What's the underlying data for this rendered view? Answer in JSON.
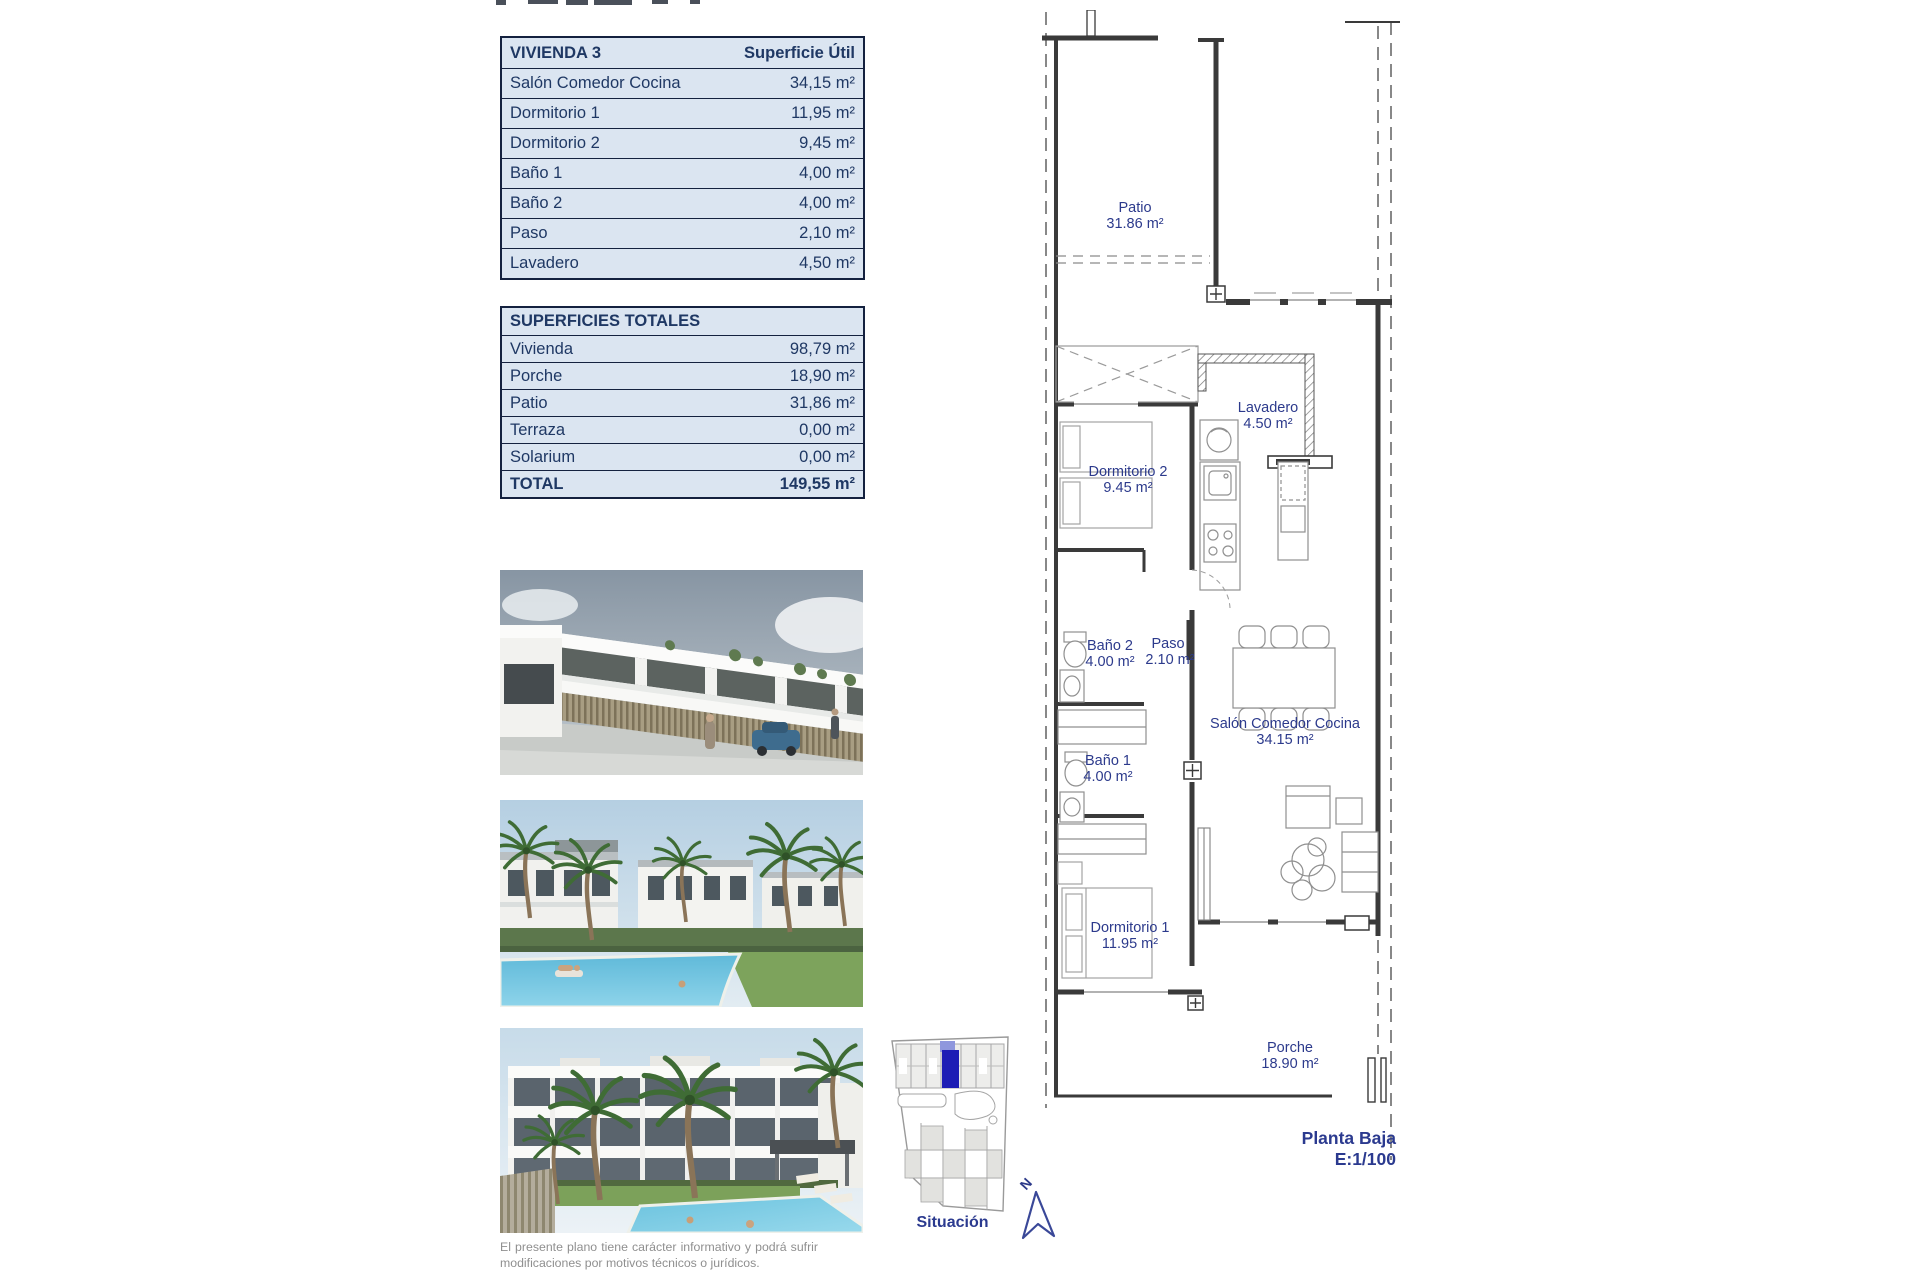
{
  "tables": {
    "vivienda": {
      "title": "VIVIENDA 3",
      "header_value": "Superficie Útil",
      "rows": [
        {
          "label": "Salón Comedor Cocina",
          "value": "34,15 m²"
        },
        {
          "label": "Dormitorio 1",
          "value": "11,95 m²"
        },
        {
          "label": "Dormitorio 2",
          "value": "9,45 m²"
        },
        {
          "label": "Baño 1",
          "value": "4,00 m²"
        },
        {
          "label": "Baño 2",
          "value": "4,00 m²"
        },
        {
          "label": "Paso",
          "value": "2,10 m²"
        },
        {
          "label": "Lavadero",
          "value": "4,50 m²"
        }
      ]
    },
    "totales": {
      "title": "SUPERFICIES TOTALES",
      "rows": [
        {
          "label": "Vivienda",
          "value": "98,79 m²"
        },
        {
          "label": "Porche",
          "value": "18,90 m²"
        },
        {
          "label": "Patio",
          "value": "31,86 m²"
        },
        {
          "label": "Terraza",
          "value": "0,00 m²"
        },
        {
          "label": "Solarium",
          "value": "0,00 m²"
        }
      ],
      "total_row": {
        "label": "TOTAL",
        "value": "149,55 m²"
      }
    }
  },
  "floorplan": {
    "rooms": [
      {
        "name": "Patio",
        "area": "31.86 m²"
      },
      {
        "name": "Lavadero",
        "area": "4.50 m²"
      },
      {
        "name": "Dormitorio 2",
        "area": "9.45 m²"
      },
      {
        "name": "Baño 2",
        "area": "4.00 m²"
      },
      {
        "name": "Paso",
        "area": "2.10 m²"
      },
      {
        "name": "Baño 1",
        "area": "4.00 m²"
      },
      {
        "name": "Salón Comedor Cocina",
        "area": "34.15 m²"
      },
      {
        "name": "Dormitorio 1",
        "area": "11.95 m²"
      },
      {
        "name": "Porche",
        "area": "18.90 m²"
      }
    ],
    "caption": {
      "line1": "Planta Baja",
      "line2": "E:1/100"
    },
    "north_label": "N"
  },
  "siteplan": {
    "caption": "Situación"
  },
  "disclaimer": "El presente plano tiene carácter informativo y podrá sufrir modificaciones por motivos técnicos o jurídicos.",
  "colors": {
    "navy": "#1f3864",
    "table_bg": "#dbe5f1",
    "plan_label": "#2c3a8c",
    "highlight_blue": "#1d1db5"
  }
}
